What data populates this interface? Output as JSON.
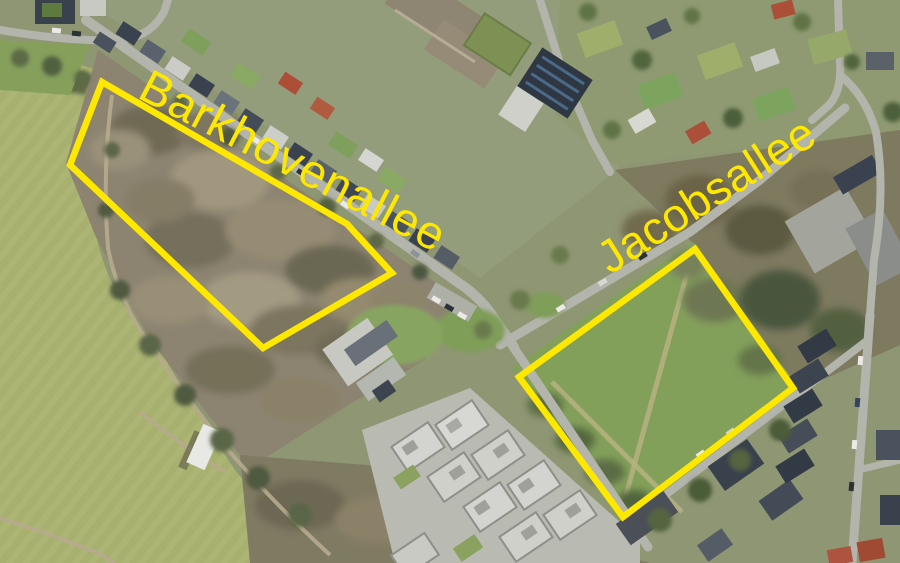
{
  "annotation_color": "#ffe800",
  "parcels": [
    {
      "label": "Barkhovenallee",
      "polygon_points": "102,82 70,165 263,348 392,273 347,224"
    },
    {
      "label": "Jacobsallee",
      "polygon_points": "695,249 793,388 623,517 519,377"
    }
  ]
}
